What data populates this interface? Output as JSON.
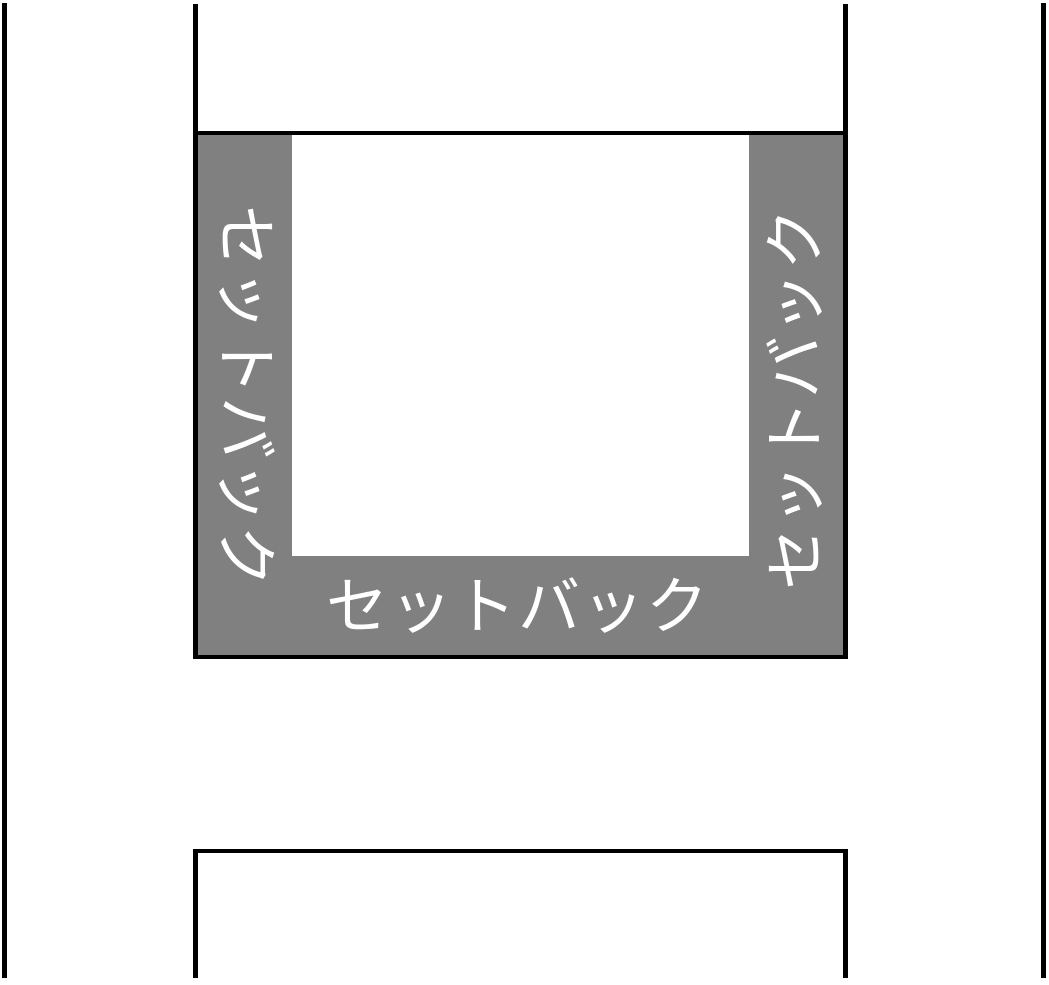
{
  "diagram": {
    "type": "setback-zoning-diagram",
    "setback_area": {
      "fill_color": "#808080",
      "label_color": "#ffffff",
      "labels": {
        "left": "セットバック",
        "right": "セットバック",
        "bottom": "セットバック"
      }
    },
    "buildable_area": {
      "fill_color": "#ffffff"
    },
    "lines": {
      "color": "#000000",
      "thickness_px": 5
    },
    "background_color": "#ffffff"
  }
}
